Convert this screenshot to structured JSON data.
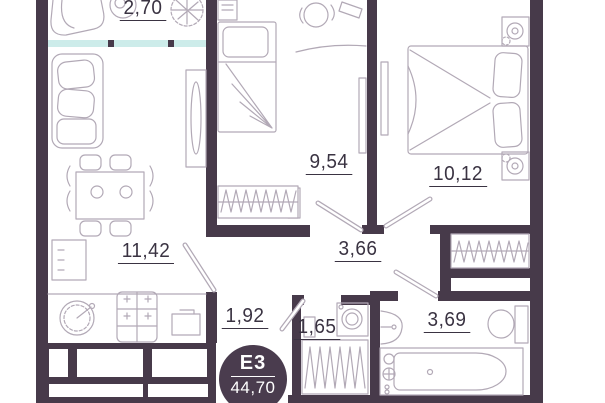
{
  "plan": {
    "badge": {
      "label": "E3",
      "total_area": "44,70"
    },
    "rooms": [
      {
        "id": "balcony",
        "area": "2,70"
      },
      {
        "id": "bedroom-small",
        "area": "9,54"
      },
      {
        "id": "bedroom-master",
        "area": "10,12"
      },
      {
        "id": "kitchen-living",
        "area": "11,42"
      },
      {
        "id": "hallway",
        "area": "3,66"
      },
      {
        "id": "corridor",
        "area": "1,92"
      },
      {
        "id": "laundry-wc",
        "area": "1,65"
      },
      {
        "id": "bathroom",
        "area": "3,69"
      }
    ],
    "colors": {
      "wall": "#473a4a",
      "window": "#cdecea",
      "furniture_line": "#b2a9b6",
      "label_text": "#3a3342",
      "badge_bg": "#4a3c4e",
      "badge_text": "#ffffff",
      "background": "#ffffff"
    }
  }
}
